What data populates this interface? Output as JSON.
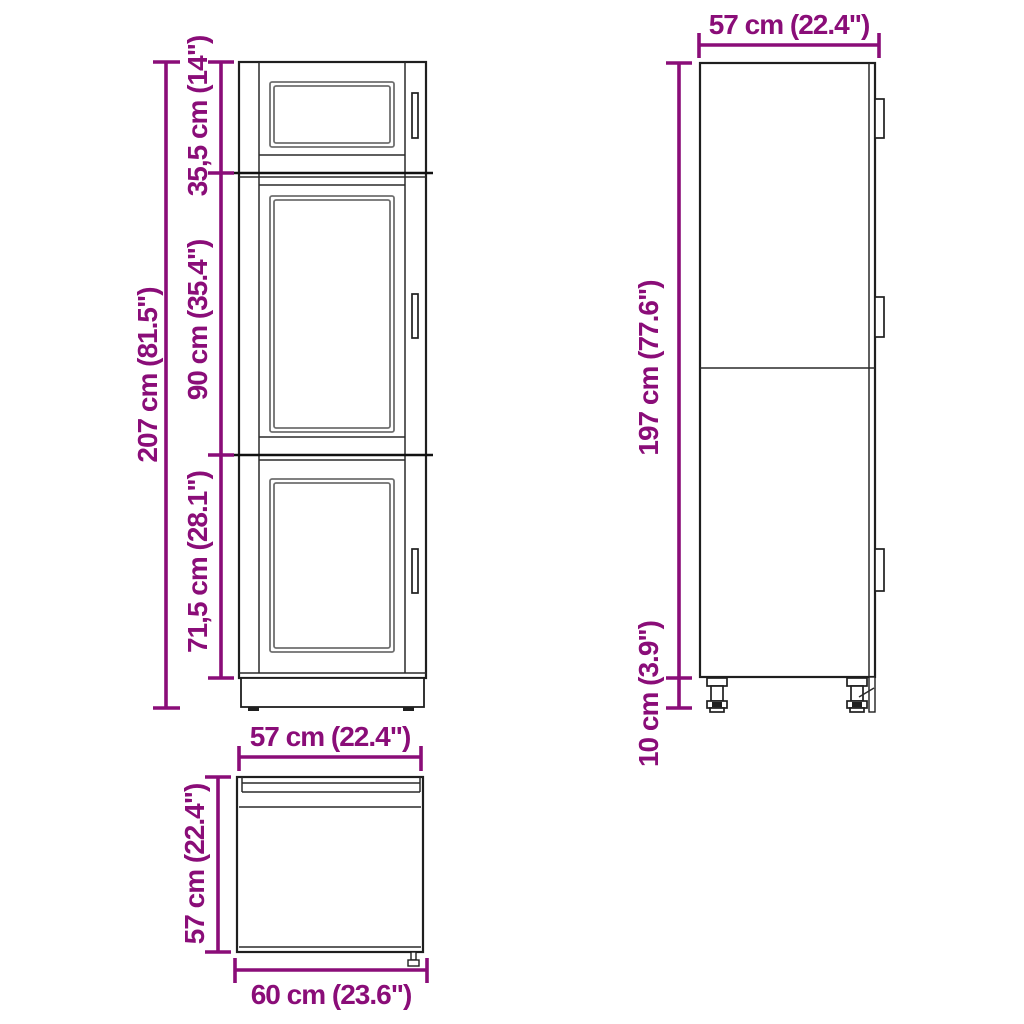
{
  "drawing": {
    "kind": "furniture dimensional line drawing",
    "subject": "tall kitchen cabinet with three shaker doors and adjustable feet",
    "style": {
      "dimension_color": "#8a0d78",
      "outline_color": "#1f1f1f",
      "background_color": "#ffffff"
    },
    "views": {
      "front": {
        "name": "front-elevation",
        "dimensions": {
          "total_height": {
            "label": "207 cm (81.5\")"
          },
          "top_section_height": {
            "label": "35,5 cm (14\")"
          },
          "middle_section_height": {
            "label": "90 cm (35.4\")"
          },
          "bottom_section_height": {
            "label": "71,5 cm (28.1\")"
          }
        }
      },
      "side": {
        "name": "side-elevation",
        "dimensions": {
          "depth": {
            "label": "57 cm (22.4\")"
          },
          "carcass_height": {
            "label": "197 cm (77.6\")"
          },
          "feet_height": {
            "label": "10 cm (3.9\")"
          }
        }
      },
      "top": {
        "name": "plan-view",
        "dimensions": {
          "inner_width": {
            "label": "57 cm (22.4\")"
          },
          "depth": {
            "label": "57 cm (22.4\")"
          },
          "overall_width": {
            "label": "60 cm (23.6\")"
          }
        }
      }
    }
  }
}
